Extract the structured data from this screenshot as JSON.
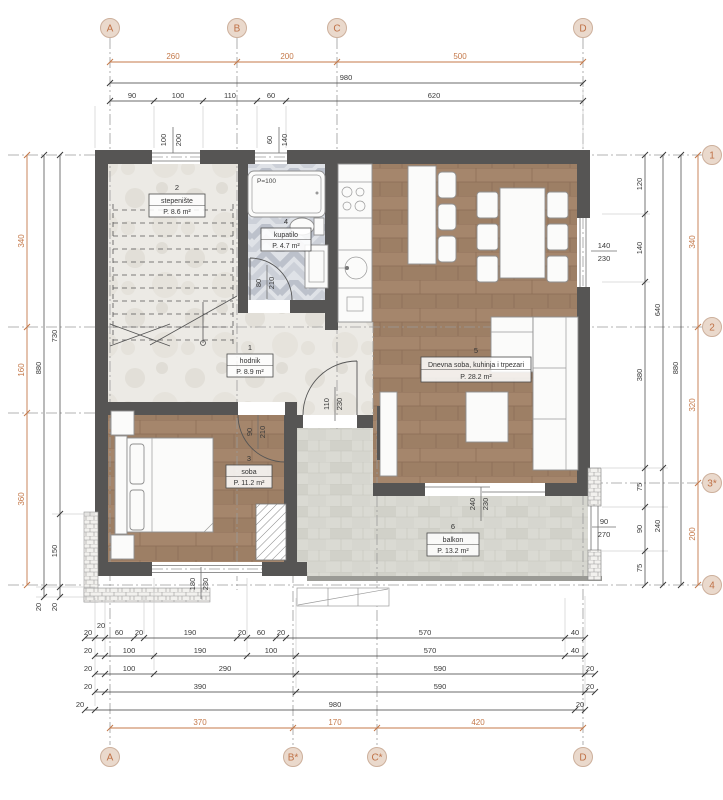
{
  "title": "floor-plan",
  "colors": {
    "accent_orange": "#c4794a",
    "wall": "#565554",
    "wood": "#a5866c",
    "marble": "#eceae5",
    "tile": "#dfe2e7",
    "paver": "#dadad3"
  },
  "grid": {
    "top": [
      "A",
      "B",
      "C",
      "D"
    ],
    "bottom": [
      "A",
      "B*",
      "C*",
      "D"
    ],
    "right": [
      "1",
      "2",
      "3*",
      "4"
    ]
  },
  "rooms": [
    {
      "num": "1",
      "name": "hodnik",
      "area": "P. 8.9 m²"
    },
    {
      "num": "2",
      "name": "stepenište",
      "area": "P. 8.6 m²"
    },
    {
      "num": "3",
      "name": "soba",
      "area": "P. 11.2 m²"
    },
    {
      "num": "4",
      "name": "kupatilo",
      "area": "P. 4.7 m²"
    },
    {
      "num": "5",
      "name": "Dnevna soba, kuhinja i trpezari",
      "area": "P. 28.2 m²"
    },
    {
      "num": "6",
      "name": "balkon",
      "area": "P. 13.2 m²"
    }
  ],
  "dims": {
    "top_axes": [
      "260",
      "200",
      "500"
    ],
    "top_total": "980",
    "top_segs": [
      "90",
      "100",
      "110",
      "60",
      "620"
    ],
    "win_top1": [
      "100",
      "200"
    ],
    "win_top2": [
      "60",
      "140"
    ],
    "left_axes": [
      "340",
      "160",
      "360"
    ],
    "left_col1": [
      "880",
      "20"
    ],
    "left_col2": [
      "730",
      "150",
      "20"
    ],
    "right_col1": [
      "120",
      "140",
      "380",
      "75",
      "90",
      "75"
    ],
    "right_col2": [
      "640",
      "240"
    ],
    "right_col3": [
      "880"
    ],
    "right_axes": [
      "340",
      "320",
      "200"
    ],
    "win_right": [
      "140",
      "230"
    ],
    "win_balcony": [
      "90",
      "270"
    ],
    "door_bath": [
      "80",
      "210"
    ],
    "door_bed": [
      "90",
      "210"
    ],
    "door_entry": [
      "110",
      "230"
    ],
    "door_balcony": [
      "240",
      "230"
    ],
    "win_bed": [
      "180",
      "230"
    ],
    "bottom_r1": [
      "20",
      "20",
      "60",
      "20",
      "190",
      "20",
      "60",
      "20",
      "570",
      "40"
    ],
    "bottom_r2": [
      "20",
      "100",
      "190",
      "100",
      "570",
      "40"
    ],
    "bottom_r3": [
      "20",
      "100",
      "290",
      "590",
      "20"
    ],
    "bottom_r4": [
      "20",
      "390",
      "590",
      "20"
    ],
    "bottom_r5": [
      "20",
      "980",
      "20"
    ],
    "bottom_axes": [
      "370",
      "170",
      "420"
    ],
    "tub": "P=100"
  }
}
